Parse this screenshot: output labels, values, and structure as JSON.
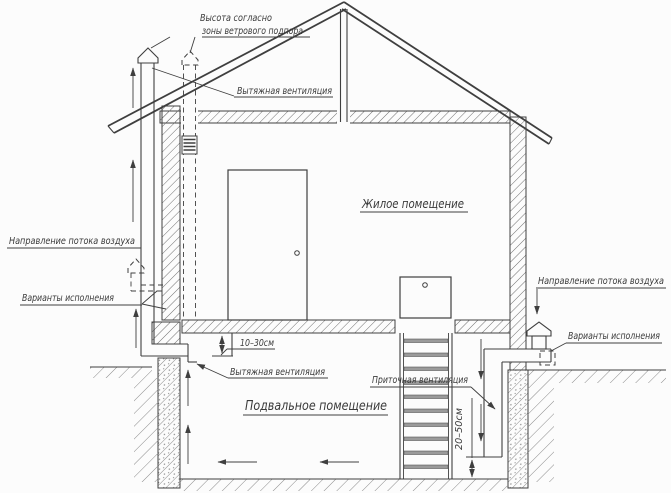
{
  "diagram": {
    "type": "house-ventilation-cross-section",
    "labels": {
      "wind_zone_height_line1": "Высота согласно",
      "wind_zone_height_line2": "зоны ветрового подпора",
      "exhaust_vent_top": "Вытяжная вентиляция",
      "living_room": "Жилое помещение",
      "airflow_left": "Направление потока воздуха",
      "variants_left": "Варианты исполнения",
      "dim_floor_gap": "10–30см",
      "exhaust_vent_bottom": "Вытяжная вентиляция",
      "basement": "Подвальное помещение",
      "supply_vent": "Приточная вентиляция",
      "airflow_right": "Направление потока воздуха",
      "variants_right": "Варианты исполнения",
      "dim_supply_gap": "20–50см"
    },
    "colors": {
      "line": "#3f3f3f",
      "text": "#3a3a3a",
      "background": "#fcfcfc",
      "hatch": "#6f6f6f"
    }
  }
}
